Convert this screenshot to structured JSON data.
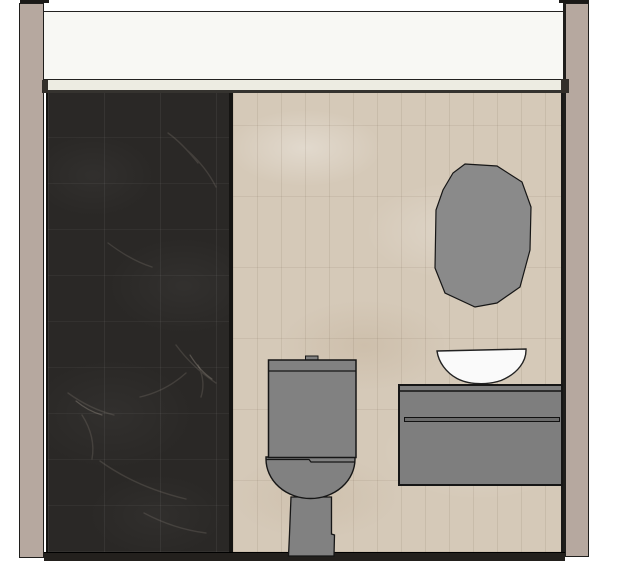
{
  "app": {
    "view_type": "interior-elevation-render",
    "description": "Bathroom wall elevation with dark marble shower wall, beige tiled wall, toilet, oval mirror, vessel sink and wall-hung vanity"
  },
  "colors": {
    "background": "#ffffff",
    "wall_column": "#b6a89f",
    "ceiling": "#f8f8f4",
    "cove_band": "#edece2",
    "dark_marble_wall": "#2a2826",
    "beige_tile_wall": "#d5c9b8",
    "fixture_gray": "#818181",
    "mirror_gray": "#8a8a8a",
    "sink_white": "#fafafa",
    "vanity_gray": "#7e7e7e",
    "groove_gray": "#6b6b6b",
    "baseboard": "#23201d",
    "outline": "#161616",
    "trim_black": "#1b1a18"
  },
  "scene": {
    "objects": [
      {
        "id": "left-wall-column",
        "label": "left wall edge"
      },
      {
        "id": "right-wall-column",
        "label": "right wall edge"
      },
      {
        "id": "ceiling-bulkhead",
        "label": "ceiling bulkhead"
      },
      {
        "id": "cove-band",
        "label": "cove trim band"
      },
      {
        "id": "dark-marble-wall",
        "label": "dark marble feature wall"
      },
      {
        "id": "beige-tile-wall",
        "label": "beige tiled wall"
      },
      {
        "id": "baseboard",
        "label": "baseboard"
      },
      {
        "id": "mirror",
        "label": "faceted oval mirror"
      },
      {
        "id": "vessel-sink",
        "label": "white vessel sink bowl"
      },
      {
        "id": "vanity-cabinet",
        "label": "wall-hung vanity cabinet"
      },
      {
        "id": "vanity-drawer-pull",
        "label": "recessed drawer pull"
      },
      {
        "id": "toilet",
        "label": "two-piece toilet"
      }
    ]
  }
}
